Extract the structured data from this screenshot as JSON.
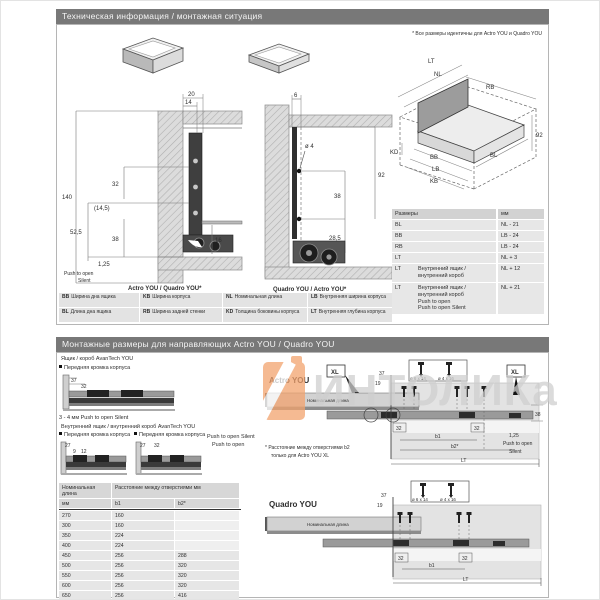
{
  "watermark": {
    "text": "ИНТОЛИКа"
  },
  "top": {
    "title": "Техническая информация / монтажная ситуация",
    "note": "* Все размеры идентичны для Actro YOU и Quadro YOU",
    "cross_left": {
      "caption": "Actro YOU / Quadro YOU*",
      "d20": "20",
      "d14": "14",
      "d140": "140",
      "d32": "32",
      "d145": "(14,5)",
      "d525": "52,5",
      "d38": "38",
      "d16": "16",
      "d125": "1,25",
      "push1": "Push to open",
      "push2": "Silent"
    },
    "cross_right": {
      "caption": "Quadro YOU / Actro YOU*",
      "d6": "6",
      "dd4": "ø 4",
      "d38": "38",
      "d92": "92",
      "d285": "28,5"
    },
    "iso": {
      "lt": "LT",
      "nl": "NL",
      "rb": "RB",
      "d92": "92",
      "kd": "KD",
      "bb": "BB",
      "bl": "BL",
      "lb": "LB",
      "kb": "KB"
    },
    "size_table": {
      "col_name": "Размеры",
      "col_unit": "мм",
      "rows": [
        {
          "code": "BL",
          "desc": "",
          "value": "NL - 21"
        },
        {
          "code": "BB",
          "desc": "",
          "value": "LB - 24"
        },
        {
          "code": "RB",
          "desc": "",
          "value": "LB - 24"
        },
        {
          "code": "LT",
          "desc": "",
          "value": "NL + 3"
        },
        {
          "code": "LT",
          "desc": "Внутренний ящик /\nвнутренний короб",
          "value": "NL + 12"
        },
        {
          "code": "LT",
          "desc": "Внутренний ящик /\nвнутренний короб\nPush to open\nPush to open Silent",
          "value": "NL + 21"
        }
      ]
    },
    "legend": {
      "items": [
        {
          "code": "BB",
          "text": "Ширина дна ящика"
        },
        {
          "code": "KB",
          "text": "Ширина корпуса"
        },
        {
          "code": "NL",
          "text": "Номинальная длина"
        },
        {
          "code": "LB",
          "text": "Внутренняя ширина корпуса"
        },
        {
          "code": "BL",
          "text": "Длина дна ящика"
        },
        {
          "code": "RB",
          "text": "Ширина задней стенки"
        },
        {
          "code": "KD",
          "text": "Толщина боковины корпуса"
        },
        {
          "code": "LT",
          "text": "Внутренняя глубина корпуса"
        }
      ]
    }
  },
  "bottom": {
    "title": "Монтажные размеры для направляющих Actro YOU / Quadro YOU",
    "left": {
      "box_label": "Ящик / короб AvanTech YOU",
      "front_edge": "Передняя кромка корпуса",
      "d1a": "37",
      "d1b": "32",
      "gap_note": "3 - 4 мм Push to open Silent",
      "inner_label": "Внутренний ящик / внутренний короб AvanTech YOU",
      "d2a": "27",
      "d2b": "9",
      "d2c": "12",
      "d3a": "27",
      "d3b": "32",
      "push_silent": "Push to open Silent",
      "push_open": "Push to open"
    },
    "hole_table": {
      "h_nominal": "Номинальная длина",
      "h_mm": "мм",
      "h_dist": "Расстояние между отверстиями мм",
      "h_b1": "b1",
      "h_b2": "b2*",
      "rows": [
        [
          "270",
          "160",
          ""
        ],
        [
          "300",
          "160",
          ""
        ],
        [
          "350",
          "224",
          ""
        ],
        [
          "400",
          "224",
          ""
        ],
        [
          "450",
          "256",
          "288"
        ],
        [
          "500",
          "256",
          "320"
        ],
        [
          "550",
          "256",
          "320"
        ],
        [
          "600",
          "256",
          "320"
        ],
        [
          "650",
          "256",
          "416"
        ]
      ]
    },
    "actro": {
      "label": "Actro YOU",
      "xl": "XL",
      "nominal": "Номинальная длина",
      "d37": "37",
      "d19": "19",
      "screw1": "ø 6 x 14",
      "screw2": "ø 4 x 16",
      "d38": "38",
      "d125": "1,25",
      "push1": "Push to open",
      "push2": "Silent",
      "d32a": "32",
      "b1": "b1",
      "b2": "b2*",
      "d32b": "32",
      "lt": "LT",
      "note1": "* Расстояние между отверстиями b2",
      "note2": "только для Actro YOU XL"
    },
    "quadro": {
      "label": "Quadro YOU",
      "nominal": "Номинальная длина",
      "d37": "37",
      "d19": "19",
      "screw1": "ø 6 x 14",
      "screw2": "ø 4 x 16",
      "d32a": "32",
      "b1": "b1",
      "d32b": "32",
      "lt": "LT"
    }
  }
}
